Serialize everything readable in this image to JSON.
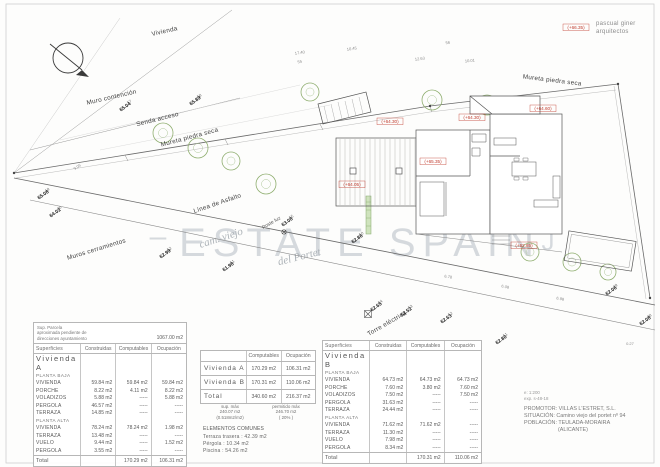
{
  "architect": {
    "line1": "pascual giner",
    "line2": "arquitectos"
  },
  "watermark": {
    "dash": "–",
    "text": "ESTATE SPAIN",
    "bracket": "J",
    "street1": "cam. viejo",
    "street2": "del Portet"
  },
  "plan": {
    "labels": [
      {
        "t": "Vivienda",
        "x": 165,
        "y": 33,
        "r": -13
      },
      {
        "t": "Muro contención",
        "x": 112,
        "y": 99,
        "r": -13
      },
      {
        "t": "Senda acceso",
        "x": 158,
        "y": 121,
        "r": -14
      },
      {
        "t": "Mureta piedra seca",
        "x": 190,
        "y": 139,
        "r": -15
      },
      {
        "t": "Mureta piedra seca",
        "x": 552,
        "y": 82,
        "r": 7
      },
      {
        "t": "Línea de Asfalto",
        "x": 218,
        "y": 205,
        "r": -19
      },
      {
        "t": "Muros cerramientos",
        "x": 97,
        "y": 251,
        "r": -17
      },
      {
        "t": "Torre eléctrica",
        "x": 388,
        "y": 325,
        "r": -30
      }
    ],
    "small_labels": [
      {
        "t": "Poste luz",
        "x": 272,
        "y": 224,
        "r": -30
      }
    ],
    "red_labels": [
      {
        "t": "(+64.30)",
        "x": 390,
        "y": 123
      },
      {
        "t": "(+64.30)",
        "x": 472,
        "y": 119
      },
      {
        "t": "(+64.60)",
        "x": 543,
        "y": 110
      },
      {
        "t": "(+65.35)",
        "x": 433,
        "y": 163
      },
      {
        "t": "(+64.05)",
        "x": 352,
        "y": 186
      },
      {
        "t": "(+62.85)",
        "x": 524,
        "y": 247
      },
      {
        "t": "(+66.35)",
        "x": 576,
        "y": 29
      }
    ],
    "markers": [
      {
        "id": "57",
        "elev": "65.04",
        "x": 126,
        "y": 108
      },
      {
        "id": "58",
        "elev": "65.89",
        "x": 196,
        "y": 102
      },
      {
        "id": "19",
        "elev": "65.08",
        "x": 44,
        "y": 196
      },
      {
        "id": "20",
        "elev": "64.02",
        "x": 56,
        "y": 214
      },
      {
        "id": "55",
        "elev": "63.08",
        "x": 288,
        "y": 223
      },
      {
        "id": "52",
        "elev": "62.99",
        "x": 166,
        "y": 255
      },
      {
        "id": "51",
        "elev": "61.98",
        "x": 229,
        "y": 268
      },
      {
        "id": "50",
        "elev": "62.86",
        "x": 358,
        "y": 240
      },
      {
        "id": "54",
        "elev": "62.65",
        "x": 377,
        "y": 308
      },
      {
        "id": "53",
        "elev": "62.52",
        "x": 407,
        "y": 313
      },
      {
        "id": "52",
        "elev": "62.63",
        "x": 447,
        "y": 320
      },
      {
        "id": "51",
        "elev": "62.80",
        "x": 502,
        "y": 341
      },
      {
        "id": "49",
        "elev": "62.06",
        "x": 612,
        "y": 292
      },
      {
        "id": "48",
        "elev": "62.08",
        "x": 646,
        "y": 322
      }
    ],
    "dims": [
      {
        "t": "17.40",
        "x": 300,
        "y": 54,
        "r": -9
      },
      {
        "t": "10.45",
        "x": 352,
        "y": 50,
        "r": -9
      },
      {
        "t": "12.63",
        "x": 420,
        "y": 60,
        "r": -7
      },
      {
        "t": "10.01",
        "x": 470,
        "y": 62,
        "r": -6
      },
      {
        "t": "55",
        "x": 300,
        "y": 63,
        "r": -10
      },
      {
        "t": "56",
        "x": 448,
        "y": 44,
        "r": -8
      },
      {
        "t": "6.78",
        "x": 448,
        "y": 278,
        "r": 10
      },
      {
        "t": "6.08",
        "x": 505,
        "y": 288,
        "r": 11
      },
      {
        "t": "6.98",
        "x": 560,
        "y": 300,
        "r": 12
      },
      {
        "t": "0.27",
        "x": 630,
        "y": 345,
        "r": 0
      },
      {
        "t": "9.06",
        "x": 78,
        "y": 168,
        "r": -35
      }
    ],
    "trees": [
      [
        163,
        133,
        10
      ],
      [
        198,
        148,
        10
      ],
      [
        231,
        161,
        9
      ],
      [
        266,
        184,
        10
      ],
      [
        310,
        92,
        9
      ],
      [
        432,
        100,
        10
      ],
      [
        487,
        105,
        10
      ],
      [
        530,
        252,
        9
      ],
      [
        572,
        262,
        9
      ],
      [
        608,
        272,
        8
      ]
    ]
  },
  "tables": {
    "parcel_note": {
      "l1": "Sup. Parcela",
      "l2": "aproximada pendiente de",
      "l3": "direcciones ayuntamiento",
      "area": "1067.00 m2"
    },
    "headers": {
      "superficies": "Superficies",
      "construidas": "Construidas",
      "computables": "Computables",
      "ocupacion": "Ocupación"
    },
    "viviendaA": {
      "title": "Vivienda   A",
      "rows": [
        {
          "s": "PLANTA BAJA"
        },
        {
          "l": "VIVIENDA",
          "v": [
            "59.84 m2",
            "59.84 m2",
            "59.84 m2"
          ]
        },
        {
          "l": "PORCHE",
          "v": [
            "8.22 m2",
            "4.11 m2",
            "8.22 m2"
          ]
        },
        {
          "l": "VOLADIZOS",
          "v": [
            "5.88 m2",
            "-----",
            "5.88 m2"
          ]
        },
        {
          "l": "PERGOLA",
          "v": [
            "46.57 m2",
            "-----",
            "-----"
          ]
        },
        {
          "l": "TERRAZA",
          "v": [
            "14.85 m2",
            "-----",
            "-----"
          ]
        },
        {
          "s": "PLANTA ALTA"
        },
        {
          "l": "VIVIENDA",
          "v": [
            "78.24 m2",
            "78.24 m2",
            "1.98 m2"
          ]
        },
        {
          "l": "TERRAZA",
          "v": [
            "13.48 m2",
            "-----",
            "-----"
          ]
        },
        {
          "l": "VUELO",
          "v": [
            "9.44 m2",
            "-----",
            "1.52 m2"
          ]
        },
        {
          "l": "PERGOLA",
          "v": [
            "3.55 m2",
            "-----",
            "-----"
          ]
        }
      ],
      "total": {
        "l": "Total",
        "v": [
          "",
          "170.29 m2",
          "106.31 m2"
        ]
      }
    },
    "viviendaB": {
      "title": "Vivienda   B",
      "rows": [
        {
          "s": "PLANTA BAJA"
        },
        {
          "l": "VIVIENDA",
          "v": [
            "64.73 m2",
            "64.73 m2",
            "64.73 m2"
          ]
        },
        {
          "l": "PORCHE",
          "v": [
            "7.60 m2",
            "3.80 m2",
            "7.60 m2"
          ]
        },
        {
          "l": "VOLADIZOS",
          "v": [
            "7.50 m2",
            "-----",
            "7.50 m2"
          ]
        },
        {
          "l": "PERGOLA",
          "v": [
            "31.63 m2",
            "-----",
            "-----"
          ]
        },
        {
          "l": "TERRAZA",
          "v": [
            "24.44 m2",
            "-----",
            "-----"
          ]
        },
        {
          "s": "PLANTA ALTA"
        },
        {
          "l": "VIVIENDA",
          "v": [
            "71.62 m2",
            "71.62 m2",
            "-----"
          ]
        },
        {
          "l": "TERRAZA",
          "v": [
            "11.30 m2",
            "-----",
            "-----"
          ]
        },
        {
          "l": "VUELO",
          "v": [
            "7.98 m2",
            "-----",
            "-----"
          ]
        },
        {
          "l": "PERGOLA",
          "v": [
            "8.34 m2",
            "-----",
            "-----"
          ]
        }
      ],
      "total": {
        "l": "Total",
        "v": [
          "",
          "170.31 m2",
          "110.06 m2"
        ]
      }
    },
    "summary": {
      "head": [
        "",
        "Computables",
        "Ocupación"
      ],
      "rows": [
        [
          "Vivienda   A",
          "170.29 m2",
          "106.31 m2"
        ],
        [
          "Vivienda   B",
          "170.31 m2",
          "110.06 m2"
        ],
        [
          "Total",
          "340.60 m2",
          "216.37 m2"
        ]
      ]
    },
    "limits": {
      "left": [
        "sup. máx",
        "240.07 m2",
        "(0.518m2/m2)"
      ],
      "right": [
        "permitido máx",
        "246.70 m2",
        "( 20% )"
      ]
    },
    "comunes": {
      "title": "ELEMENTOS COMUNES",
      "rows": [
        "Terraza trasera : 42.39 m2",
        "Pérgola : 10.34 m2",
        "Piscina : 54.26 m2"
      ]
    }
  },
  "titleblock": {
    "scale": "e: 1:200",
    "exp": "exp. s-48-18",
    "promotor": "PROMOTOR: VILLAS L'ESTRET, S.L.",
    "situacion": "SITUACIÓN: Camino viejo del portet nº 94",
    "poblacion": "POBLACIÓN: TEULADA-MORAIRA",
    "provincia": "(ALICANTE)"
  }
}
